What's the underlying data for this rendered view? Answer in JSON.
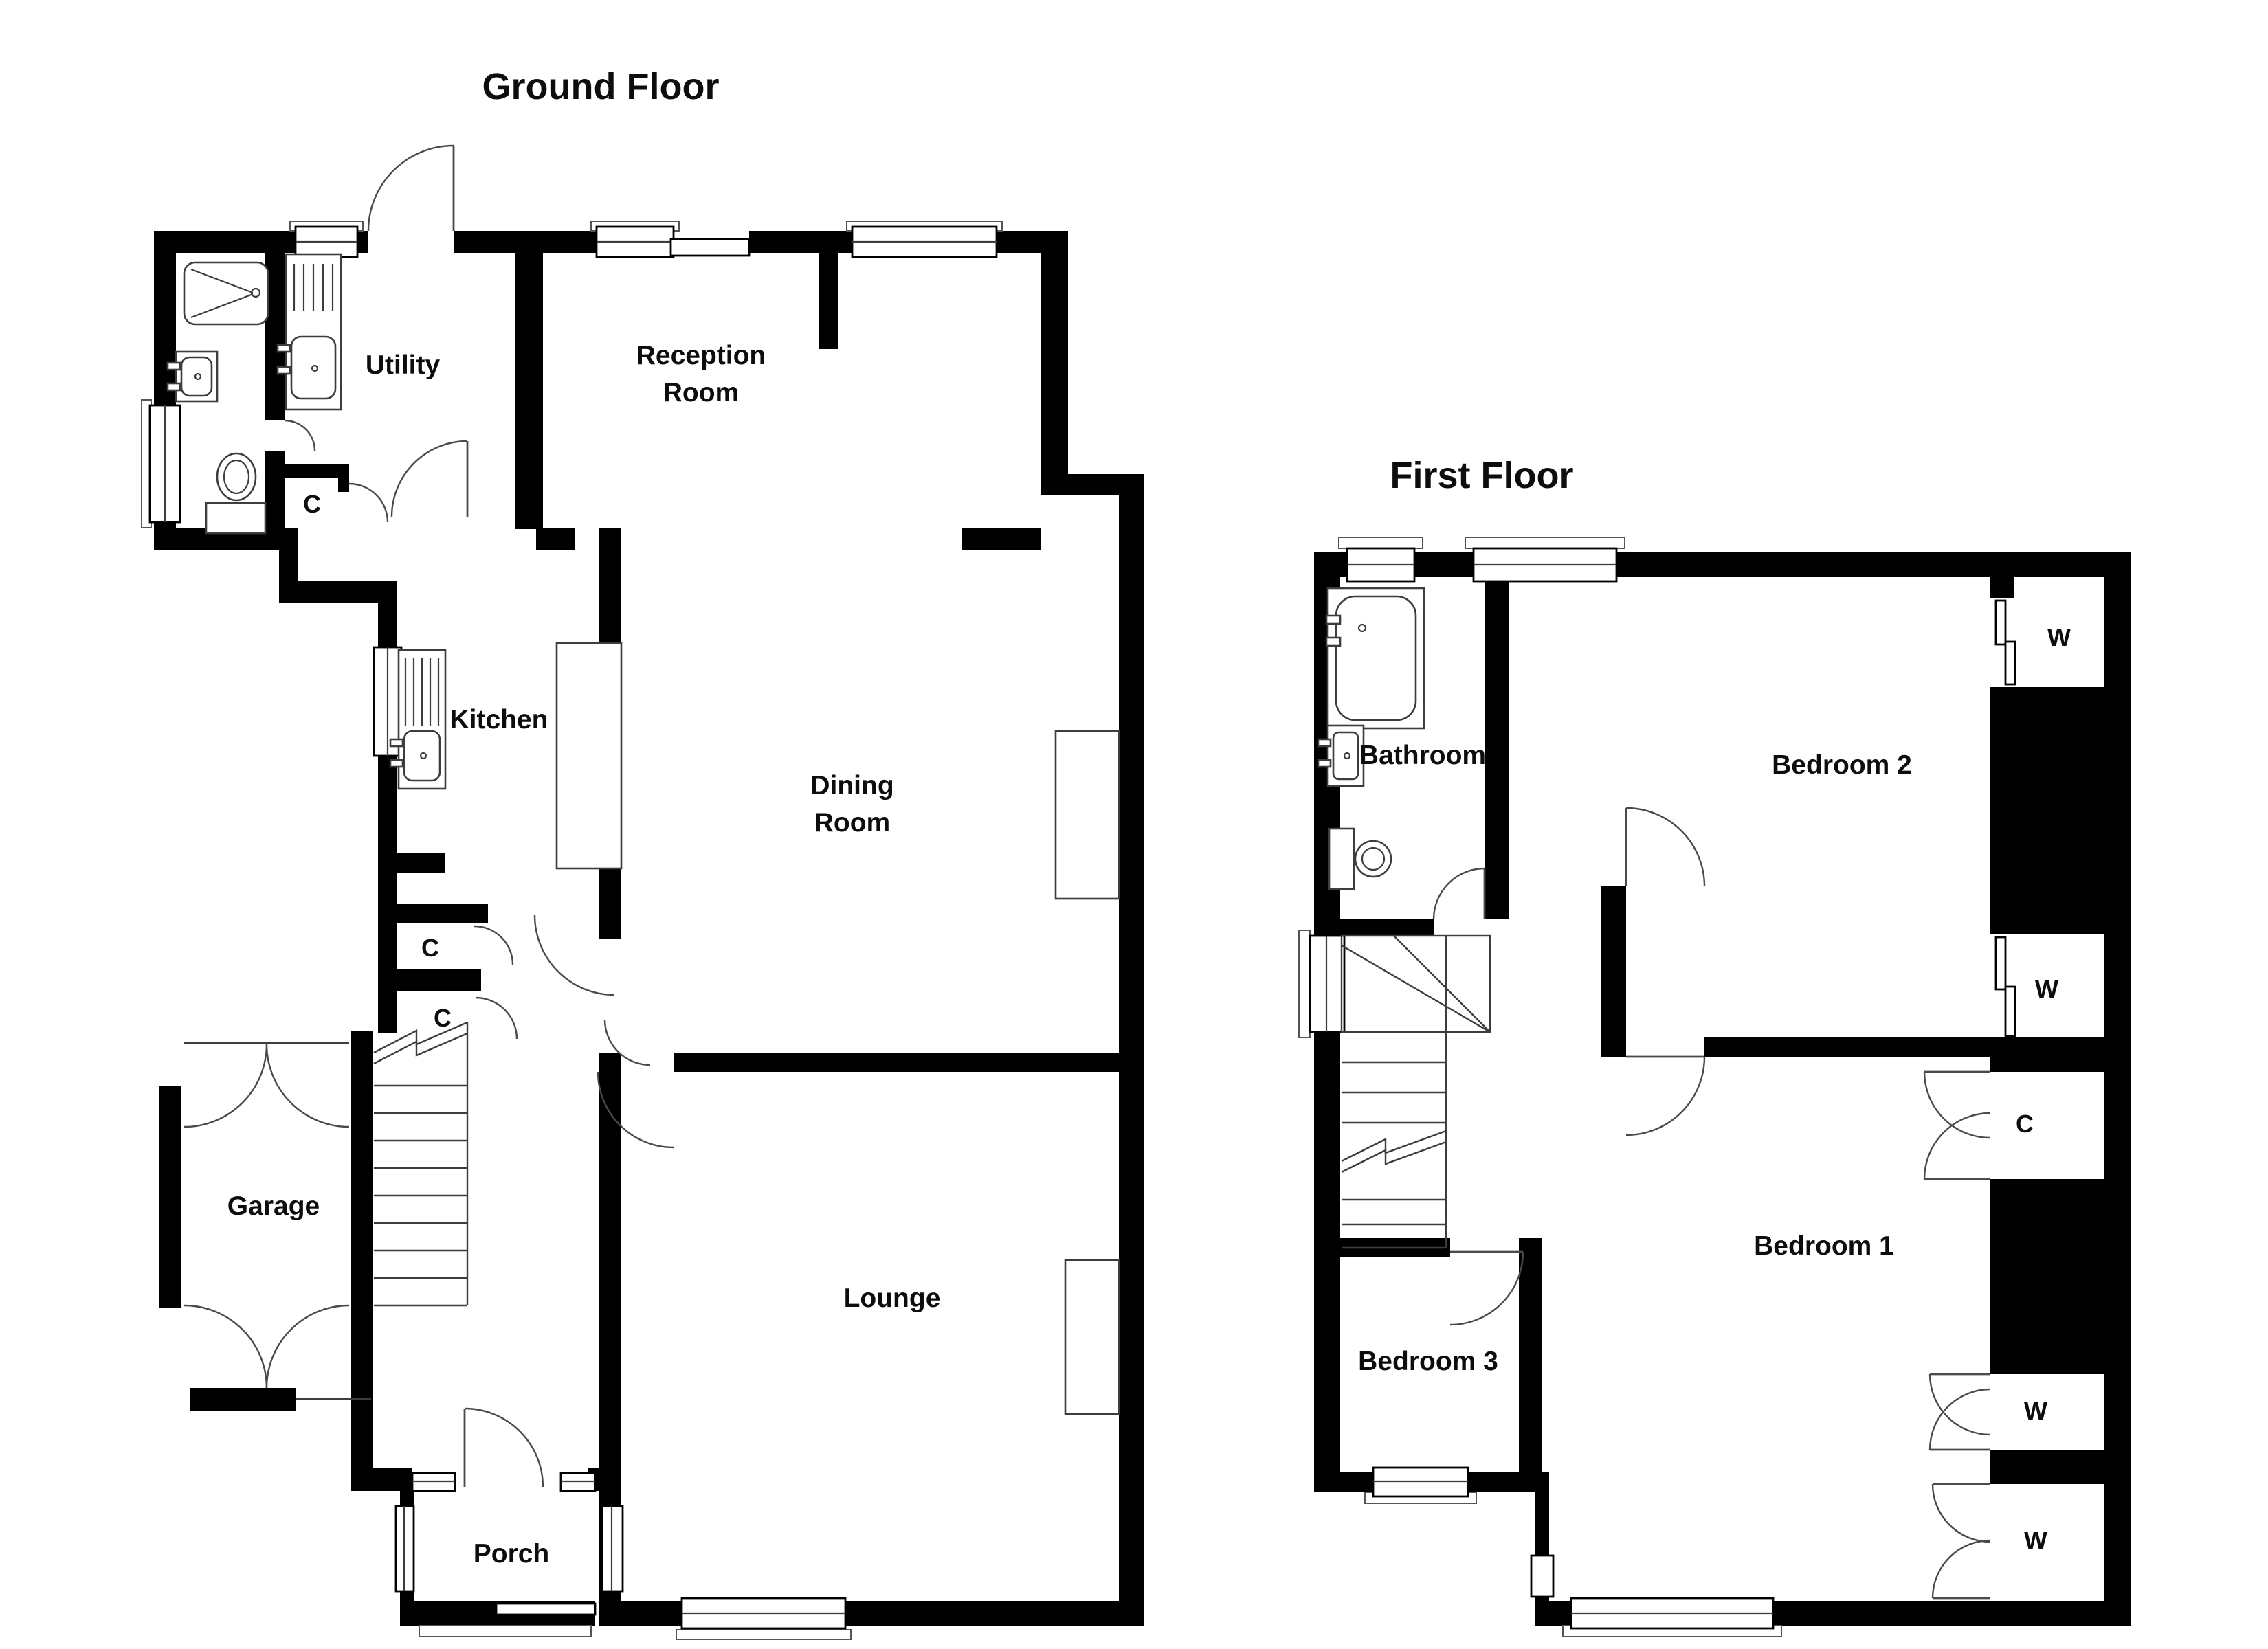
{
  "titles": {
    "ground": "Ground Floor",
    "first": "First Floor"
  },
  "rooms": {
    "ground": {
      "utility": "Utility",
      "reception_line1": "Reception",
      "reception_line2": "Room",
      "kitchen": "Kitchen",
      "dining_line1": "Dining",
      "dining_line2": "Room",
      "garage": "Garage",
      "lounge": "Lounge",
      "porch": "Porch"
    },
    "first": {
      "bathroom": "Bathroom",
      "bedroom1": "Bedroom 1",
      "bedroom2": "Bedroom 2",
      "bedroom3": "Bedroom 3"
    }
  },
  "labels": {
    "closet": "C",
    "wardrobe": "W"
  },
  "colors": {
    "wall": "#000000",
    "background": "#ffffff",
    "fixture_line": "#3d3d3d",
    "text": "#0d0d0d"
  }
}
